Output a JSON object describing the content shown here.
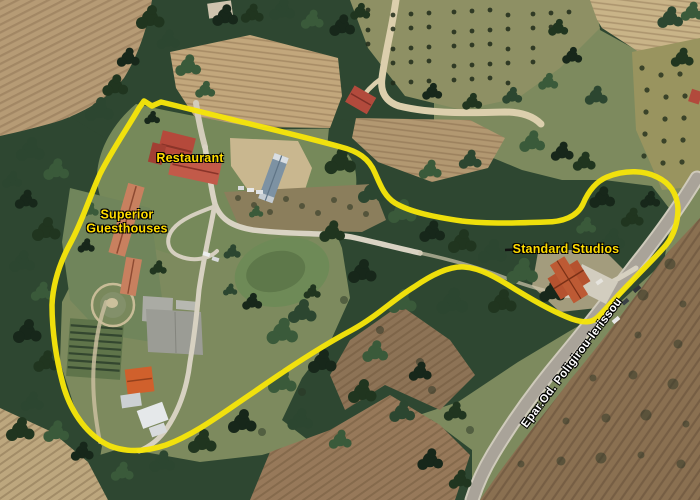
{
  "map": {
    "type": "satellite-aerial-view",
    "labels": {
      "restaurant": "Restaurant",
      "superior_line1": "Superior",
      "superior_line2": "Guesthouses",
      "standard_studios": "Standard Studios",
      "road_name": "Epar.Od. Poligirou-Ierissou"
    },
    "annotation": {
      "outline_color": "#F5E40A",
      "label_color": "#FFDC00",
      "road_label_color": "#FFFFFF",
      "pointer_color": "#101010"
    }
  }
}
